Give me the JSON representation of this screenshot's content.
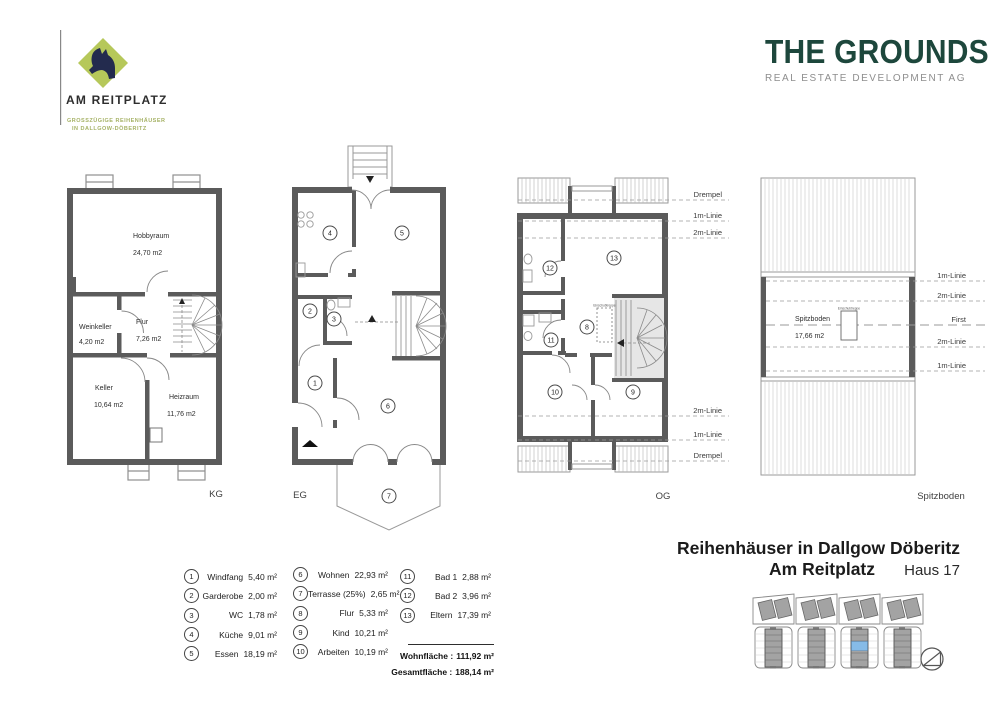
{
  "branding": {
    "left_logo": {
      "name": "AM REITPLATZ",
      "tagline1": "GROSSZÜGIGE REIHENHÄUSER",
      "tagline2": "IN DALLGOW-DÖBERITZ",
      "diamond_color": "#b6c85a",
      "horse_color": "#232b4e"
    },
    "right_logo": {
      "name": "THE GROUNDS",
      "subtitle": "REAL ESTATE DEVELOPMENT AG",
      "color": "#1d473c"
    }
  },
  "floors": {
    "kg": {
      "label": "KG",
      "rooms": {
        "hobbyraum": {
          "name": "Hobbyraum",
          "area": "24,70 m2"
        },
        "weinkeller": {
          "name": "Weinkeller",
          "area": "4,20 m2"
        },
        "flur": {
          "name": "Flur",
          "area": "7,26 m2"
        },
        "keller": {
          "name": "Keller",
          "area": "10,64 m2"
        },
        "heizraum": {
          "name": "Heizraum",
          "area": "11,76 m2"
        }
      }
    },
    "eg": {
      "label": "EG",
      "numbers": [
        "1",
        "2",
        "3",
        "4",
        "5",
        "6",
        "7"
      ]
    },
    "og": {
      "label": "OG",
      "numbers": [
        "8",
        "9",
        "10",
        "11",
        "12",
        "13"
      ],
      "top_lines": [
        "Drempel",
        "1m-Linie",
        "2m-Linie"
      ],
      "bottom_lines": [
        "2m-Linie",
        "1m-Linie",
        "Drempel"
      ],
      "loft_label": "Einschubtreppe"
    },
    "spitzboden": {
      "label": "Spitzboden",
      "room_name": "Spitzboden",
      "room_area": "17,66 m2",
      "lines": [
        "1m-Linie",
        "2m-Linie",
        "First",
        "2m-Linie",
        "1m-Linie"
      ],
      "loft_label": "Einschubtreppe"
    }
  },
  "legend": {
    "items": [
      {
        "num": "1",
        "name": "Windfang",
        "area": "5,40 m²"
      },
      {
        "num": "2",
        "name": "Garderobe",
        "area": "2,00 m²"
      },
      {
        "num": "3",
        "name": "WC",
        "area": "1,78 m²"
      },
      {
        "num": "4",
        "name": "Küche",
        "area": "9,01 m²"
      },
      {
        "num": "5",
        "name": "Essen",
        "area": "18,19 m²"
      },
      {
        "num": "6",
        "name": "Wohnen",
        "area": "22,93 m²"
      },
      {
        "num": "7",
        "name": "Terrasse (25%)",
        "area": "2,65 m²"
      },
      {
        "num": "8",
        "name": "Flur",
        "area": "5,33 m²"
      },
      {
        "num": "9",
        "name": "Kind",
        "area": "10,21 m²"
      },
      {
        "num": "10",
        "name": "Arbeiten",
        "area": "10,19 m²"
      },
      {
        "num": "11",
        "name": "Bad 1",
        "area": "2,88 m²"
      },
      {
        "num": "12",
        "name": "Bad 2",
        "area": "3,96 m²"
      },
      {
        "num": "13",
        "name": "Eltern",
        "area": "17,39 m²"
      }
    ],
    "totals": {
      "wohnflaeche_label": "Wohnfläche :",
      "wohnflaeche_value": "111,92 m²",
      "gesamtflaeche_label": "Gesamtfläche :",
      "gesamtflaeche_value": "188,14 m²"
    }
  },
  "title_block": {
    "line1": "Reihenhäuser in Dallgow Döberitz",
    "line2": "Am Reitplatz",
    "house": "Haus 17"
  },
  "site_plan": {
    "highlight_color": "#86bbe7"
  }
}
